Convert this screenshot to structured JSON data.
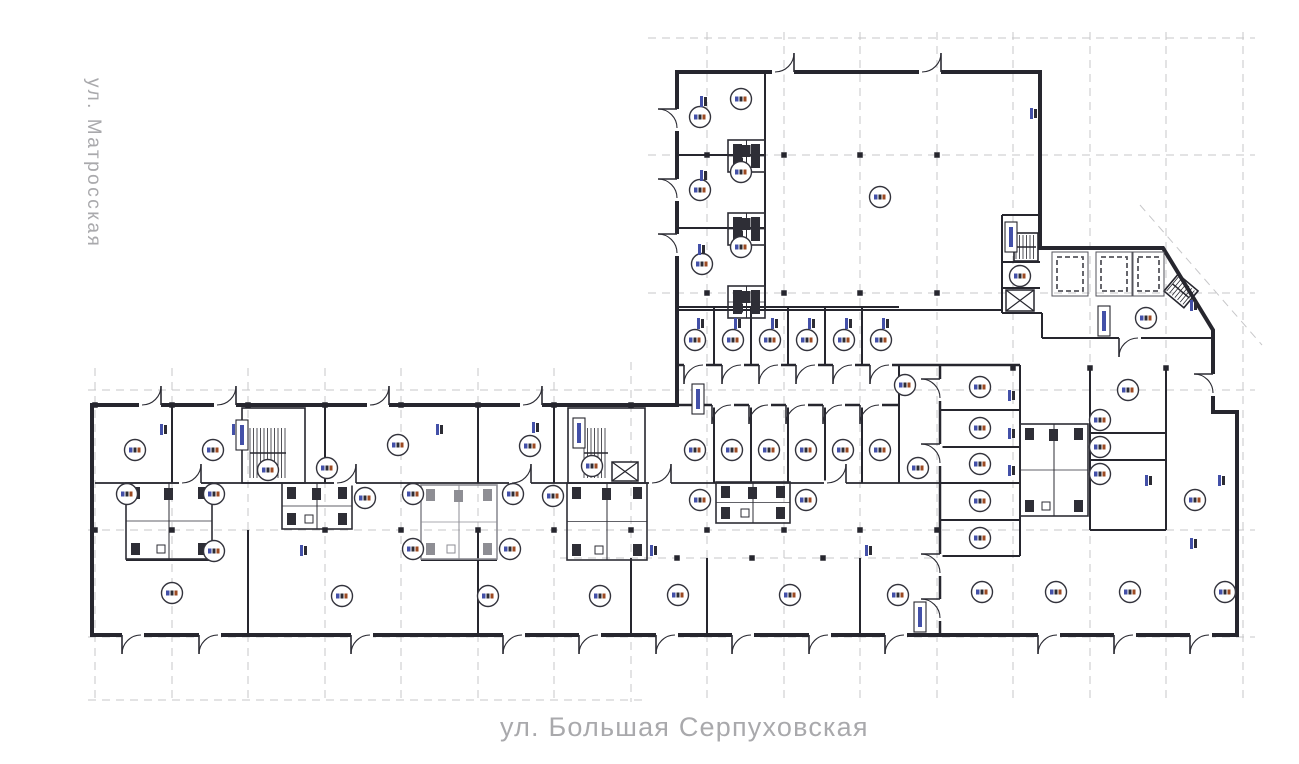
{
  "canvas": {
    "w": 1299,
    "h": 764,
    "bg": "#ffffff"
  },
  "streets": {
    "left": "ул. Матросская",
    "bottom": "ул. Большая Серпуховская",
    "color": "#a9a9ac"
  },
  "plan": {
    "colors": {
      "wall": "#26262e",
      "wall_light": "#4a4a52",
      "grid": "#c7c7c9",
      "door": "#2b2b33",
      "marker_stroke": "#33333c",
      "pod_dark": "#2e2e36",
      "pod_gray": "#8e8e94",
      "shaft": "#55555c",
      "smudge_blue": "#4350a8",
      "smudge_dark": "#2c2c34",
      "smudge_rust": "#9c4a22",
      "square": "#26262e"
    },
    "outline": "677,72 1040,72 1040,248 1163,248 1213,330 1213,412 1237,412 1237,635 92,635 92,405 677,405",
    "grid": {
      "v": [
        [
          95,
          368,
          702
        ],
        [
          172,
          368,
          702
        ],
        [
          248,
          368,
          702
        ],
        [
          325,
          368,
          702
        ],
        [
          401,
          368,
          702
        ],
        [
          478,
          368,
          702
        ],
        [
          554,
          368,
          702
        ],
        [
          631,
          362,
          702
        ],
        [
          707,
          32,
          700
        ],
        [
          784,
          32,
          700
        ],
        [
          860,
          32,
          700
        ],
        [
          937,
          32,
          700
        ],
        [
          1013,
          32,
          700
        ],
        [
          1090,
          32,
          700
        ],
        [
          1166,
          32,
          700
        ],
        [
          1243,
          32,
          700
        ]
      ],
      "h": [
        [
          38,
          648,
          1255
        ],
        [
          155,
          648,
          1255
        ],
        [
          293,
          648,
          1255
        ],
        [
          390,
          88,
          1255
        ],
        [
          530,
          88,
          1255
        ],
        [
          558,
          560,
          940
        ],
        [
          637,
          88,
          1255
        ],
        [
          700,
          88,
          648
        ]
      ],
      "diag": [
        [
          1140,
          205,
          1262,
          345
        ]
      ]
    },
    "walls": [
      [
        765,
        72,
        765,
        310
      ],
      [
        677,
        155,
        765,
        155
      ],
      [
        677,
        228,
        765,
        228
      ],
      [
        677,
        310,
        765,
        310
      ],
      [
        765,
        310,
        1002,
        310
      ],
      [
        1002,
        215,
        1002,
        313
      ],
      [
        1002,
        215,
        1040,
        215
      ],
      [
        1002,
        262,
        1040,
        262
      ],
      [
        1002,
        288,
        1040,
        288
      ],
      [
        1002,
        313,
        1042,
        313
      ],
      [
        1042,
        313,
        1042,
        338
      ],
      [
        1042,
        338,
        1213,
        338
      ],
      [
        677,
        307,
        899,
        307
      ],
      [
        714,
        307,
        714,
        365
      ],
      [
        751,
        307,
        751,
        365
      ],
      [
        788,
        307,
        788,
        365
      ],
      [
        825,
        307,
        825,
        365
      ],
      [
        862,
        307,
        862,
        365
      ],
      [
        677,
        365,
        1020,
        365,
        2.5
      ],
      [
        899,
        365,
        899,
        483
      ],
      [
        677,
        405,
        899,
        405,
        2.5
      ],
      [
        940,
        365,
        940,
        635,
        2.5
      ],
      [
        1020,
        365,
        1020,
        556
      ],
      [
        940,
        410,
        1020,
        410
      ],
      [
        940,
        447,
        1020,
        447
      ],
      [
        940,
        483,
        1020,
        483
      ],
      [
        940,
        520,
        1020,
        520
      ],
      [
        940,
        556,
        1020,
        556
      ],
      [
        1090,
        368,
        1090,
        530
      ],
      [
        1090,
        433,
        1166,
        433
      ],
      [
        1090,
        460,
        1166,
        460
      ],
      [
        1166,
        368,
        1166,
        530
      ],
      [
        1090,
        530,
        1166,
        530
      ],
      [
        95,
        483,
        940,
        483,
        1.8
      ],
      [
        126,
        560,
        212,
        560
      ],
      [
        421,
        560,
        497,
        560
      ],
      [
        172,
        405,
        172,
        483
      ],
      [
        325,
        405,
        325,
        483
      ],
      [
        478,
        405,
        478,
        483
      ],
      [
        554,
        405,
        554,
        483
      ],
      [
        714,
        405,
        714,
        483
      ],
      [
        751,
        405,
        751,
        483
      ],
      [
        788,
        405,
        788,
        483
      ],
      [
        825,
        405,
        825,
        483
      ],
      [
        862,
        405,
        862,
        483
      ],
      [
        248,
        530,
        248,
        635
      ],
      [
        478,
        530,
        478,
        635
      ],
      [
        631,
        558,
        631,
        635
      ],
      [
        707,
        558,
        707,
        635
      ],
      [
        860,
        558,
        860,
        635
      ]
    ],
    "stairs": [
      {
        "x": 242,
        "y": 408,
        "w": 63,
        "h": 75,
        "hx": 250,
        "hy": 428,
        "hw": 36,
        "hh": 50
      },
      {
        "x": 568,
        "y": 408,
        "w": 77,
        "h": 75,
        "hx": 584,
        "hy": 428,
        "hw": 24,
        "hh": 50
      },
      {
        "x": 1014,
        "y": 233,
        "w": 24,
        "h": 28,
        "hx": 1016,
        "hy": 235,
        "hw": 20,
        "hh": 24
      },
      {
        "x": 1168,
        "y": 280,
        "w": 26,
        "h": 22,
        "hx": 1170,
        "hy": 282,
        "hw": 22,
        "hh": 18,
        "rot": 40
      }
    ],
    "elevators": [
      [
        612,
        462,
        26,
        19
      ],
      [
        1006,
        290,
        28,
        21
      ]
    ],
    "shafts": [
      [
        1052,
        252,
        36,
        44
      ],
      [
        1096,
        252,
        36,
        44
      ],
      [
        1133,
        252,
        31,
        44
      ]
    ],
    "pods": [
      [
        126,
        483,
        86,
        76,
        0
      ],
      [
        282,
        483,
        70,
        46,
        0
      ],
      [
        421,
        485,
        76,
        74,
        1
      ],
      [
        567,
        483,
        80,
        77,
        0
      ],
      [
        716,
        482,
        74,
        41,
        0
      ],
      [
        1020,
        424,
        68,
        92,
        0
      ],
      [
        728,
        140,
        37,
        32,
        0
      ],
      [
        728,
        213,
        37,
        32,
        0
      ],
      [
        728,
        286,
        37,
        32,
        0
      ]
    ],
    "doors": [
      [
        783,
        72,
        "u"
      ],
      [
        930,
        72,
        "u"
      ],
      [
        677,
        120,
        "l"
      ],
      [
        677,
        190,
        "l"
      ],
      [
        677,
        245,
        "l"
      ],
      [
        150,
        405,
        "u"
      ],
      [
        225,
        405,
        "u"
      ],
      [
        378,
        405,
        "u"
      ],
      [
        531,
        405,
        "u"
      ],
      [
        695,
        365,
        "d"
      ],
      [
        733,
        365,
        "d"
      ],
      [
        770,
        365,
        "d"
      ],
      [
        807,
        365,
        "d"
      ],
      [
        844,
        365,
        "d"
      ],
      [
        881,
        365,
        "d"
      ],
      [
        723,
        405,
        "d"
      ],
      [
        760,
        405,
        "d"
      ],
      [
        797,
        405,
        "d"
      ],
      [
        834,
        405,
        "d"
      ],
      [
        871,
        405,
        "d"
      ],
      [
        940,
        390,
        "l"
      ],
      [
        940,
        455,
        "l"
      ],
      [
        940,
        565,
        "l"
      ],
      [
        940,
        610,
        "l"
      ],
      [
        1130,
        338,
        "d"
      ],
      [
        1213,
        385,
        "l"
      ],
      [
        190,
        483,
        "u"
      ],
      [
        345,
        483,
        "u"
      ],
      [
        520,
        483,
        "u"
      ],
      [
        660,
        483,
        "u"
      ],
      [
        835,
        483,
        "u"
      ],
      [
        133,
        635,
        "d"
      ],
      [
        210,
        635,
        "d"
      ],
      [
        362,
        635,
        "d"
      ],
      [
        514,
        635,
        "d"
      ],
      [
        590,
        635,
        "d"
      ],
      [
        667,
        635,
        "d"
      ],
      [
        743,
        635,
        "d"
      ],
      [
        820,
        635,
        "d"
      ],
      [
        896,
        635,
        "d"
      ],
      [
        1049,
        635,
        "d"
      ],
      [
        1125,
        635,
        "d"
      ],
      [
        1201,
        635,
        "d"
      ]
    ],
    "squares": [
      [
        707,
        155
      ],
      [
        784,
        155
      ],
      [
        860,
        155
      ],
      [
        937,
        155
      ],
      [
        707,
        293
      ],
      [
        784,
        293
      ],
      [
        860,
        293
      ],
      [
        937,
        293
      ],
      [
        95,
        405
      ],
      [
        172,
        405
      ],
      [
        248,
        405
      ],
      [
        325,
        405
      ],
      [
        401,
        405
      ],
      [
        478,
        405
      ],
      [
        554,
        405
      ],
      [
        631,
        405
      ],
      [
        95,
        530
      ],
      [
        172,
        530
      ],
      [
        325,
        530
      ],
      [
        401,
        530
      ],
      [
        478,
        530
      ],
      [
        554,
        530
      ],
      [
        631,
        530
      ],
      [
        707,
        530
      ],
      [
        784,
        530
      ],
      [
        860,
        530
      ],
      [
        937,
        530
      ],
      [
        1013,
        368
      ],
      [
        1090,
        368
      ],
      [
        1166,
        368
      ],
      [
        677,
        558
      ],
      [
        752,
        558
      ],
      [
        823,
        558
      ]
    ],
    "markers": [
      [
        700,
        117
      ],
      [
        741,
        99
      ],
      [
        700,
        190
      ],
      [
        741,
        172
      ],
      [
        702,
        264
      ],
      [
        741,
        247
      ],
      [
        880,
        197
      ],
      [
        1020,
        276
      ],
      [
        1146,
        318
      ],
      [
        1128,
        390
      ],
      [
        695,
        340
      ],
      [
        733,
        340
      ],
      [
        770,
        340
      ],
      [
        807,
        340
      ],
      [
        844,
        340
      ],
      [
        881,
        340
      ],
      [
        905,
        385
      ],
      [
        918,
        468
      ],
      [
        135,
        450
      ],
      [
        213,
        450
      ],
      [
        398,
        445
      ],
      [
        530,
        446
      ],
      [
        592,
        466
      ],
      [
        695,
        450
      ],
      [
        732,
        450
      ],
      [
        769,
        450
      ],
      [
        806,
        450
      ],
      [
        843,
        450
      ],
      [
        880,
        450
      ],
      [
        980,
        387
      ],
      [
        980,
        428
      ],
      [
        980,
        464
      ],
      [
        980,
        501
      ],
      [
        980,
        538
      ],
      [
        1100,
        420
      ],
      [
        1100,
        447
      ],
      [
        1100,
        474
      ],
      [
        1195,
        500
      ],
      [
        127,
        494
      ],
      [
        214,
        494
      ],
      [
        214,
        551
      ],
      [
        268,
        470
      ],
      [
        327,
        468
      ],
      [
        365,
        498
      ],
      [
        413,
        494
      ],
      [
        513,
        494
      ],
      [
        413,
        549
      ],
      [
        510,
        549
      ],
      [
        553,
        496
      ],
      [
        700,
        500
      ],
      [
        806,
        500
      ],
      [
        172,
        593
      ],
      [
        342,
        596
      ],
      [
        488,
        596
      ],
      [
        600,
        596
      ],
      [
        678,
        595
      ],
      [
        790,
        595
      ],
      [
        898,
        595
      ],
      [
        982,
        592
      ],
      [
        1056,
        592
      ],
      [
        1130,
        592
      ],
      [
        1225,
        592
      ]
    ],
    "smudges": [
      [
        700,
        96
      ],
      [
        700,
        170
      ],
      [
        698,
        244
      ],
      [
        1030,
        108
      ],
      [
        160,
        424
      ],
      [
        232,
        424
      ],
      [
        436,
        424
      ],
      [
        532,
        422
      ],
      [
        697,
        318
      ],
      [
        734,
        318
      ],
      [
        771,
        318
      ],
      [
        808,
        318
      ],
      [
        845,
        318
      ],
      [
        882,
        318
      ],
      [
        1008,
        390
      ],
      [
        1008,
        428
      ],
      [
        1008,
        465
      ],
      [
        1190,
        300
      ],
      [
        1145,
        475
      ],
      [
        1218,
        475
      ],
      [
        1190,
        538
      ],
      [
        300,
        545
      ],
      [
        650,
        545
      ],
      [
        865,
        545
      ]
    ],
    "boxes": [
      [
        236,
        420
      ],
      [
        573,
        418
      ],
      [
        1005,
        222
      ],
      [
        1098,
        306
      ],
      [
        914,
        602
      ],
      [
        692,
        384
      ]
    ]
  }
}
